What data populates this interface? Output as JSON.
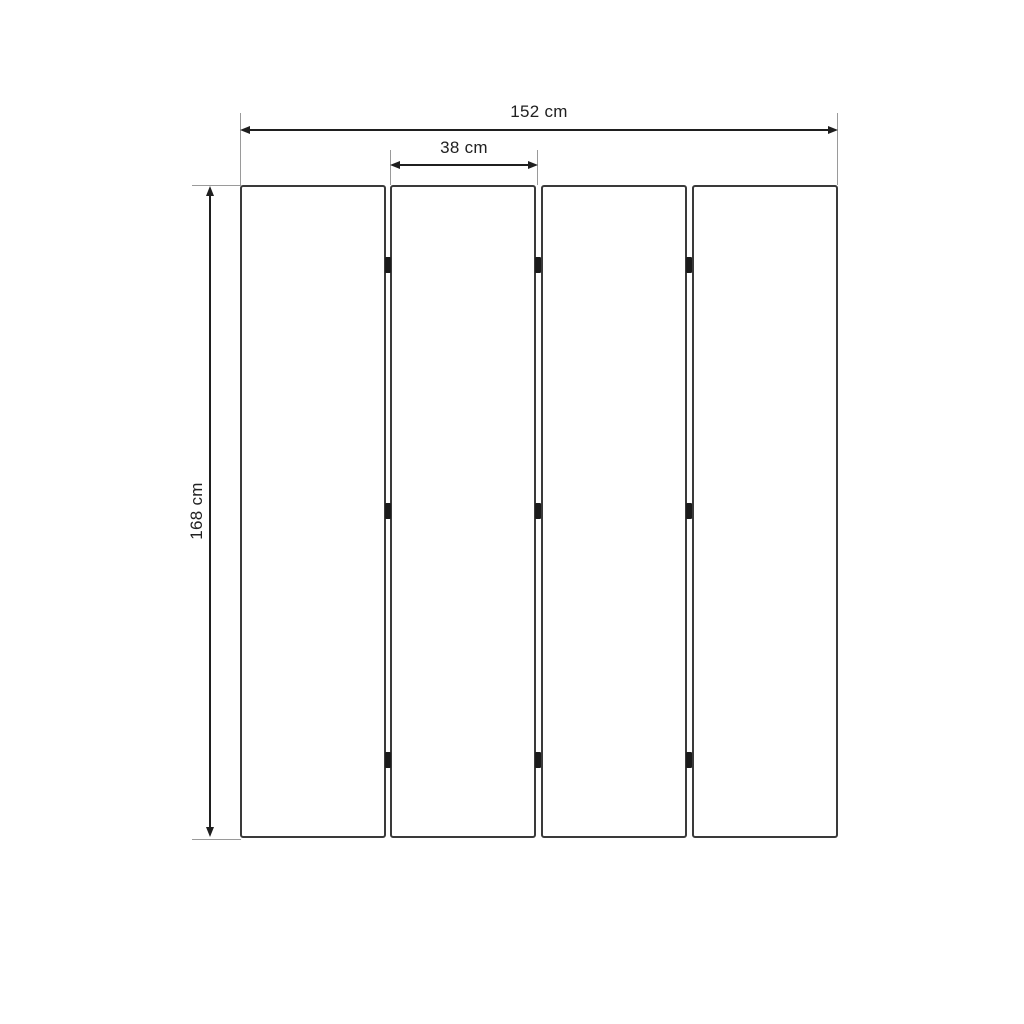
{
  "diagram": {
    "kind": "dimension-diagram",
    "subject": "four-panel folding screen (room divider), front view",
    "panel_count": 4,
    "hinge_rows": 3,
    "dimensions": {
      "total_width": {
        "label": "152 cm",
        "value": 152,
        "unit": "cm"
      },
      "panel_width": {
        "label": "38 cm",
        "value": 38,
        "unit": "cm"
      },
      "height": {
        "label": "168 cm",
        "value": 168,
        "unit": "cm"
      }
    },
    "colors": {
      "background": "#ffffff",
      "panel_border": "#3a3a3a",
      "hinge": "#1b1b1b",
      "dimension_line": "#1f1f1f",
      "extension_line": "#9a9a9a",
      "text": "#212121"
    }
  }
}
